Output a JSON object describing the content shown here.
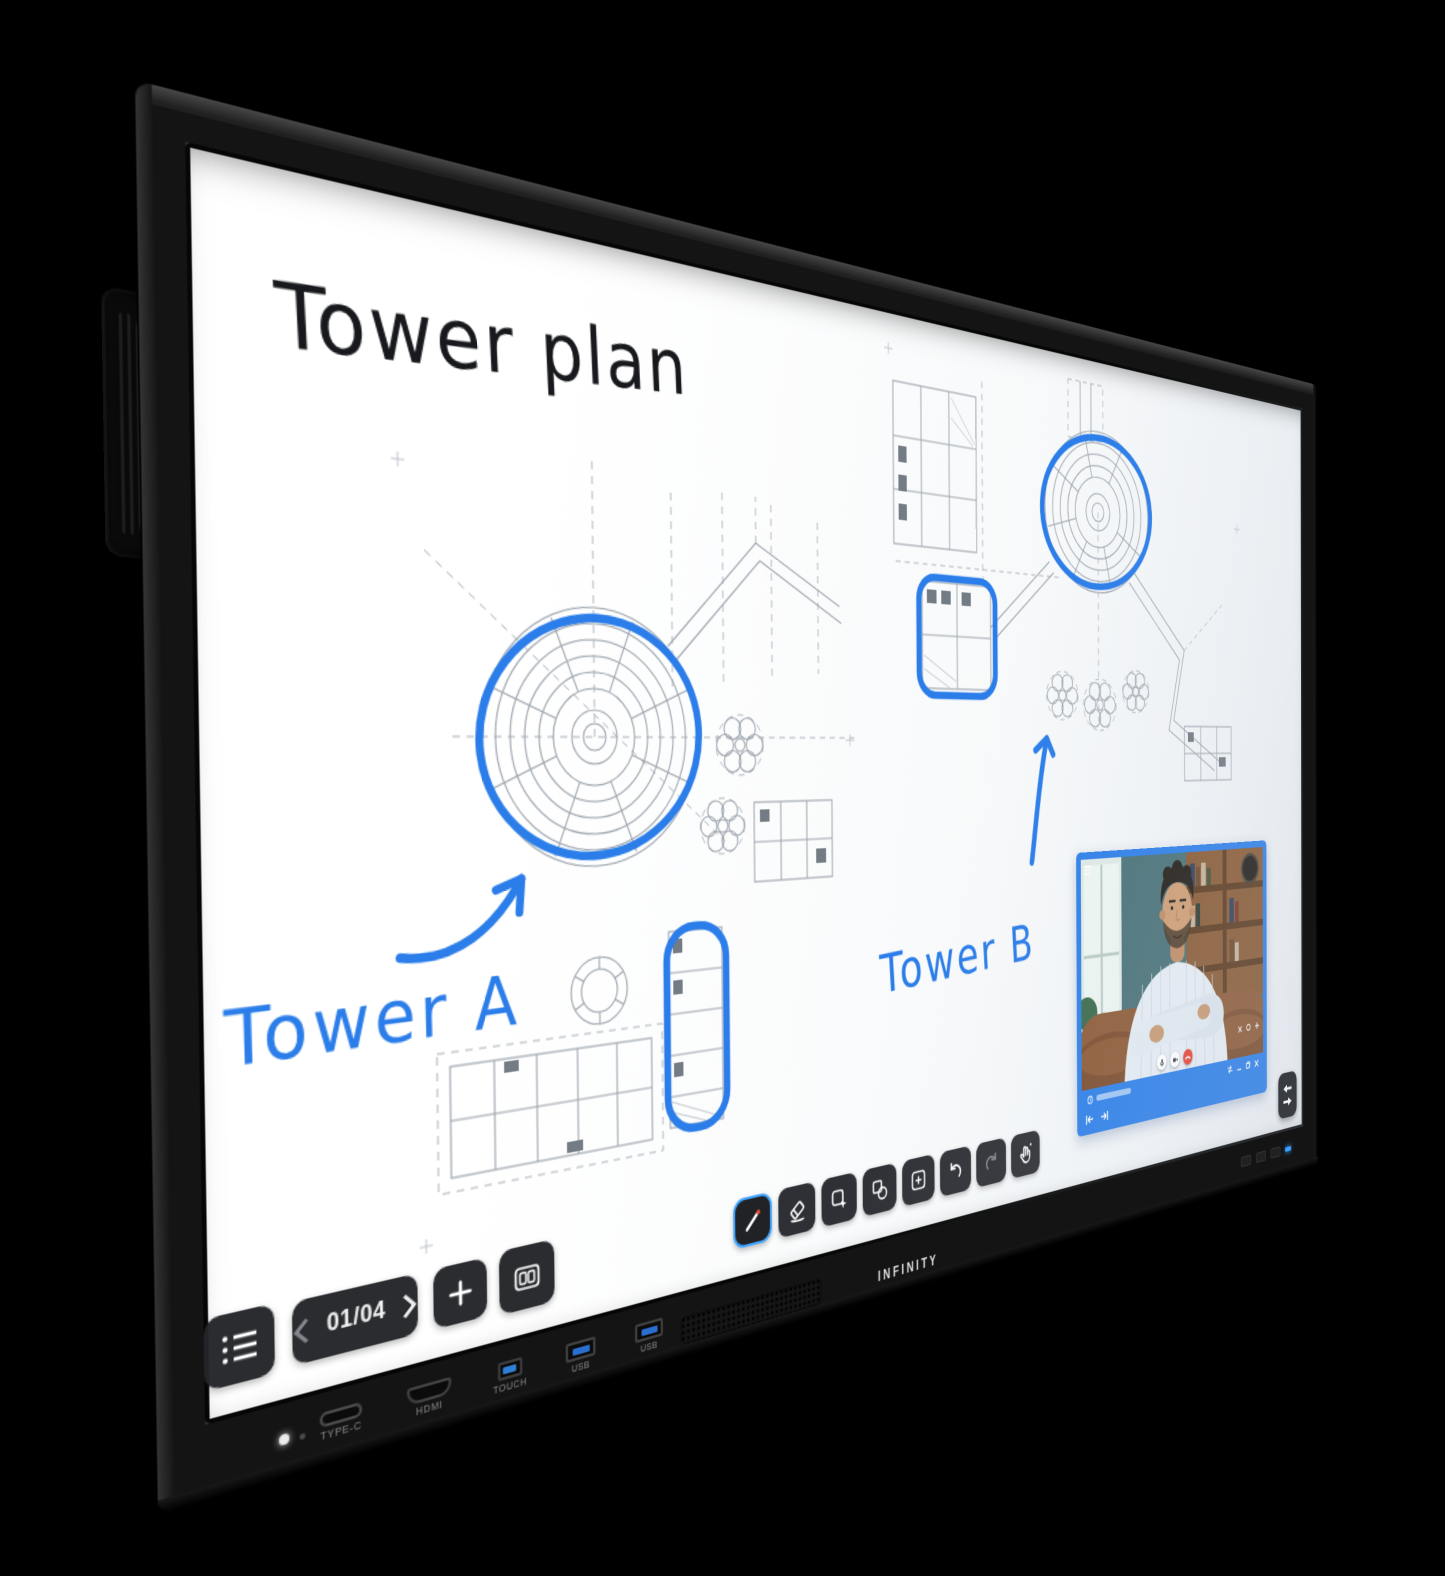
{
  "colors": {
    "annotation_blue": "#2b7de9",
    "video_frame_blue": "#2e80e8",
    "tool_selected_border": "#3fa4ff",
    "hangup_red": "#ea4335",
    "touch_port_blue": "#2f7fd6",
    "usb_port_blue": "#2a6fd0",
    "power_led_blue": "#3aa0ff"
  },
  "whiteboard": {
    "title": "Tower plan",
    "labels": {
      "tower_a": "Tower A",
      "tower_b": "Tower B"
    },
    "page_nav": {
      "current_page": "01/04"
    },
    "toolbar_tools": [
      "pen",
      "eraser",
      "select",
      "shapes",
      "add-object",
      "undo",
      "redo",
      "gesture"
    ],
    "nav_icons": [
      "page-list",
      "previous-page",
      "next-page",
      "add-page",
      "dual-page"
    ]
  },
  "video_call": {
    "control_icons": [
      "mute-mic",
      "camera",
      "hang-up"
    ],
    "window_icons": [
      "menu",
      "close",
      "record",
      "add",
      "swap",
      "minimize",
      "restore",
      "close-window",
      "skip-start",
      "skip-end"
    ],
    "floating_icon": "swap-windows"
  },
  "device": {
    "brand": "INFINITY",
    "ports": [
      {
        "label": "TYPE-C"
      },
      {
        "label": "HDMI"
      },
      {
        "label": "TOUCH"
      },
      {
        "label": "USB"
      },
      {
        "label": "USB"
      }
    ]
  }
}
